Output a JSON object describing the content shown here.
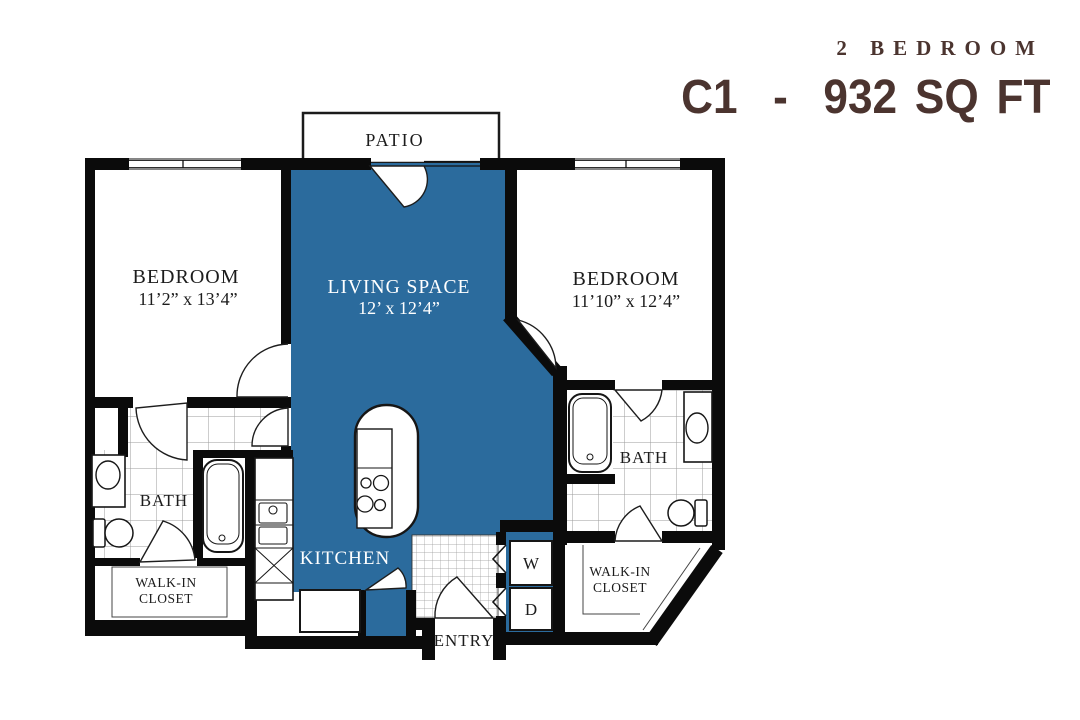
{
  "header": {
    "type_label": "2 BEDROOM",
    "plan_label": "C1  -  932 SQ FT"
  },
  "colors": {
    "accent_blue": "#2b6b9d",
    "wall_black": "#0b0b0b",
    "title_brown": "#4b342f",
    "tile_gray": "#9b9b9b",
    "label_ink": "#1c1c1c",
    "label_white": "#ffffff"
  },
  "rooms": {
    "patio": {
      "name": "PATIO"
    },
    "bedroom_left": {
      "name": "BEDROOM",
      "dimensions": "11’2” x 13’4”"
    },
    "living": {
      "name": "LIVING SPACE",
      "dimensions": "12’ x 12’4”"
    },
    "bedroom_right": {
      "name": "BEDROOM",
      "dimensions": "11’10” x 12’4”"
    },
    "bath_left": {
      "name": "BATH"
    },
    "bath_right": {
      "name": "BATH"
    },
    "kitchen": {
      "name": "KITCHEN"
    },
    "closet_left": {
      "line1": "WALK-IN",
      "line2": "CLOSET"
    },
    "closet_right": {
      "line1": "WALK-IN",
      "line2": "CLOSET"
    },
    "entry": {
      "name": "ENTRY"
    },
    "laundry": {
      "washer": "W",
      "dryer": "D"
    }
  }
}
